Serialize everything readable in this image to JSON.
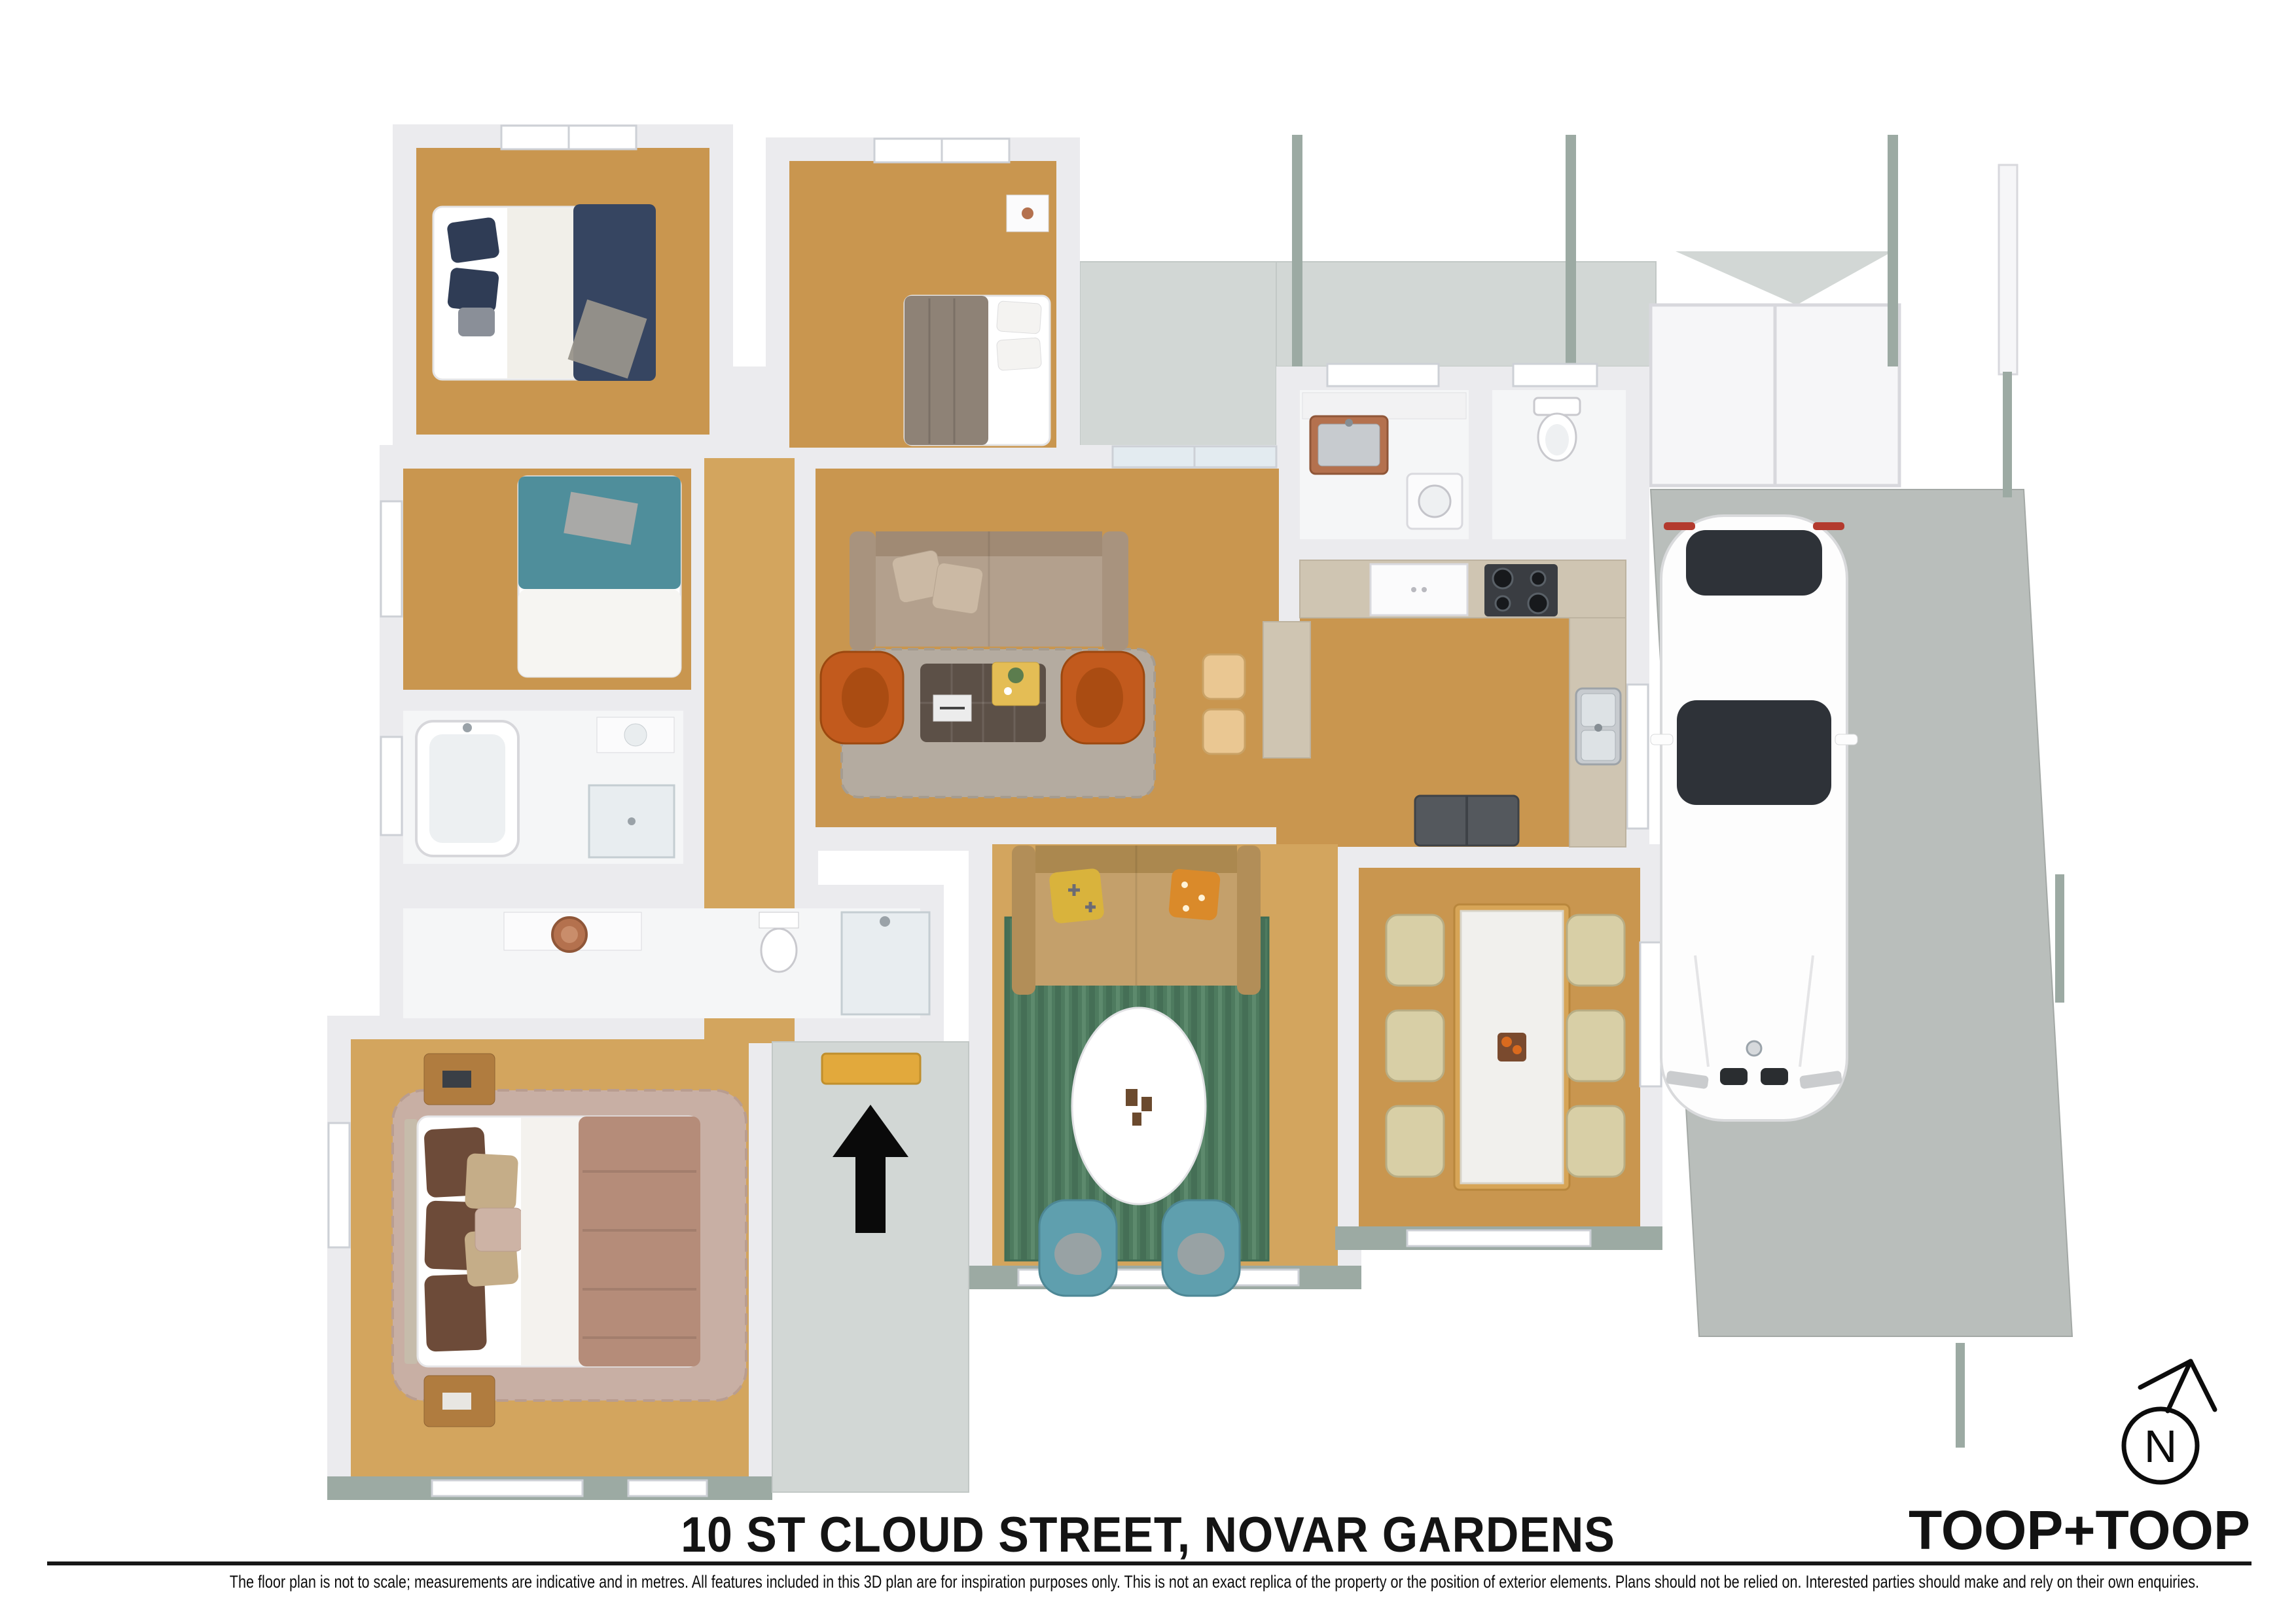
{
  "footer": {
    "title": "10 ST CLOUD STREET, NOVAR GARDENS",
    "brand": "TOOP+TOOP",
    "disclaimer": "The floor plan is not to scale; measurements are indicative and in metres. All features included in this 3D plan are for inspiration purposes only. This is not an exact replica of the property or the position of exterior elements. Plans should not be relied on. Interested parties should make and rely on their own enquiries."
  },
  "compass": {
    "label": "N"
  },
  "colors": {
    "ink": "#141414",
    "wall": "#ebebee",
    "wood": "#c9964f",
    "wood2": "#d3a55e",
    "tile": "#f5f6f7",
    "concrete": "#d2d7d5",
    "slab": "#b9bebb",
    "sage": "#9caaa3",
    "navy": "#364561",
    "graybed": "#8e8276",
    "teal": "#4f8e9b",
    "mauve": "#b58c79",
    "rugpink": "#c8afa4",
    "ruggray": "#b4aba0",
    "ruggreen": "#4e7b5f",
    "sofabeige": "#b3a08d",
    "sofatan": "#c4a06b",
    "orange": "#c25a1d",
    "tealchair": "#5f9fae",
    "cream": "#d8cfa6",
    "counter": "#cfc5b2",
    "marble": "#f1f0ed",
    "dark": "#3a3d42",
    "steel": "#c7cbcf",
    "copper": "#b4714e",
    "mat": "#e2a93c",
    "ottoman": "#5c5047",
    "woodfurn": "#b07c3f",
    "car_body": "#fdfdfd",
    "car_glass": "#2e3238"
  }
}
